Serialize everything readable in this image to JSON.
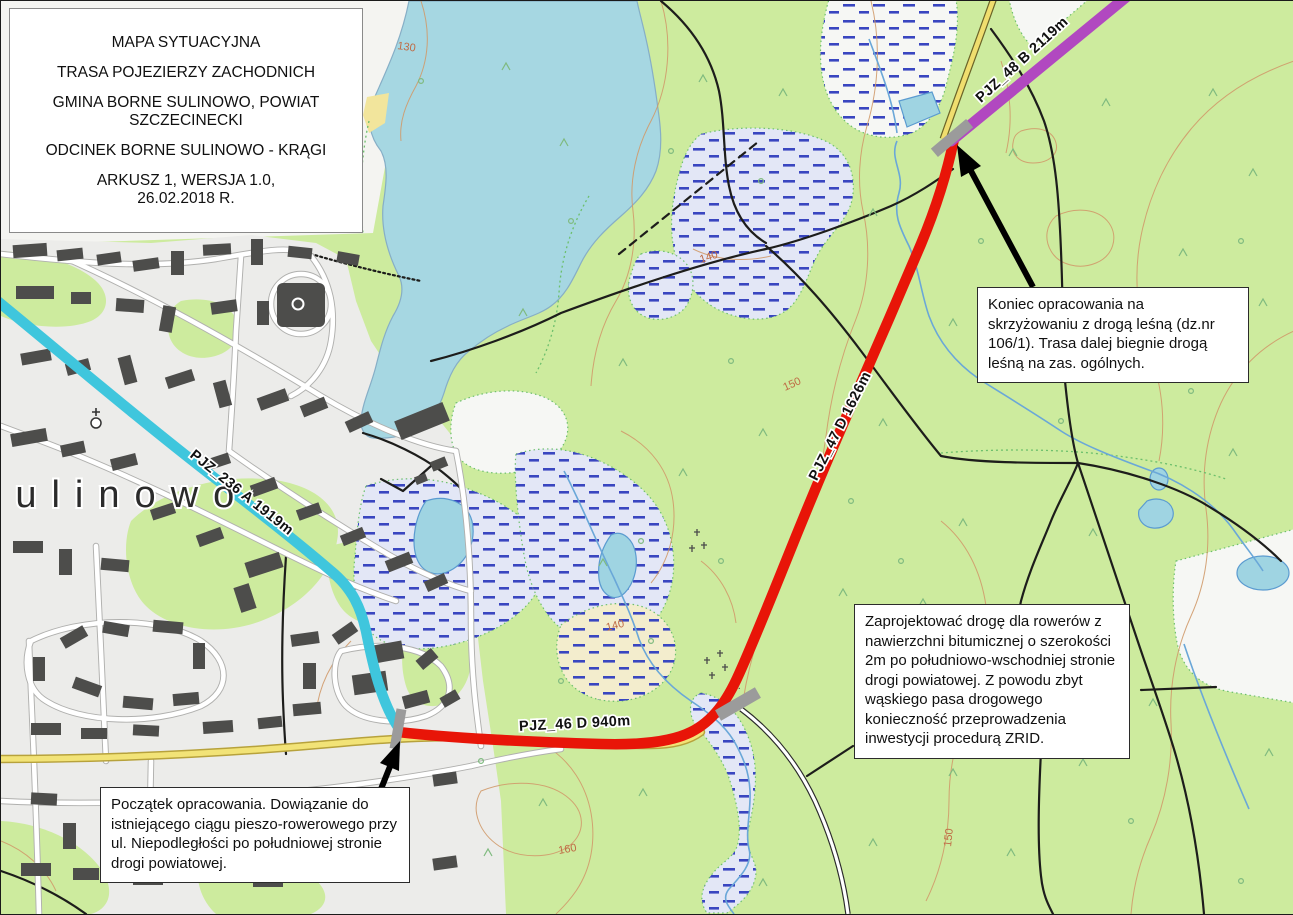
{
  "title_box": {
    "lines": [
      "MAPA SYTUACYJNA",
      "TRASA POJEZIERZY ZACHODNICH",
      "GMINA BORNE SULINOWO, POWIAT SZCZECINECKI",
      "ODCINEK BORNE SULINOWO - KRĄGI",
      "ARKUSZ 1, WERSJA 1.0,",
      "26.02.2018 R."
    ]
  },
  "annotations": {
    "koniec_text": "Koniec opracowania na skrzyżowaniu z drogą leśną (dz.nr 106/1). Trasa dalej biegnie drogą leśną na zas. ogólnych.",
    "zaprojektowac_text": "Zaprojektować drogę dla rowerów z nawierzchni bitumicznej o szerokości 2m po południowo-wschodniej stronie drogi powiatowej. Z powodu zbyt wąskiego pasa drogowego konieczność przeprowadzenia inwestycji procedurą ZRID.",
    "poczatek_text": "Początek opracowania. Dowiązanie do istniejącego ciągu pieszo-rowerowego przy ul. Niepodległości po południowej stronie drogi powiatowej."
  },
  "route_labels": {
    "blue": "PJZ_236 A 1919m",
    "red_west": "PJZ_46 D 940m",
    "red_east": "PJZ_47 D 1626m",
    "purple": "PJZ_48 B 2119m"
  },
  "map_text": {
    "town": "Sulinowo",
    "symbol_r": "R.",
    "contour_labels": [
      "130",
      "140",
      "140",
      "150",
      "150",
      "160"
    ]
  },
  "legend_colors": {
    "route_blue": "#3fc6dd",
    "route_red": "#e81508",
    "route_purple": "#b148c0",
    "marker_gray": "#9b9b9b",
    "water": "#a6d7e2",
    "forest": "#cdeb9e",
    "urban": "#ececea"
  }
}
